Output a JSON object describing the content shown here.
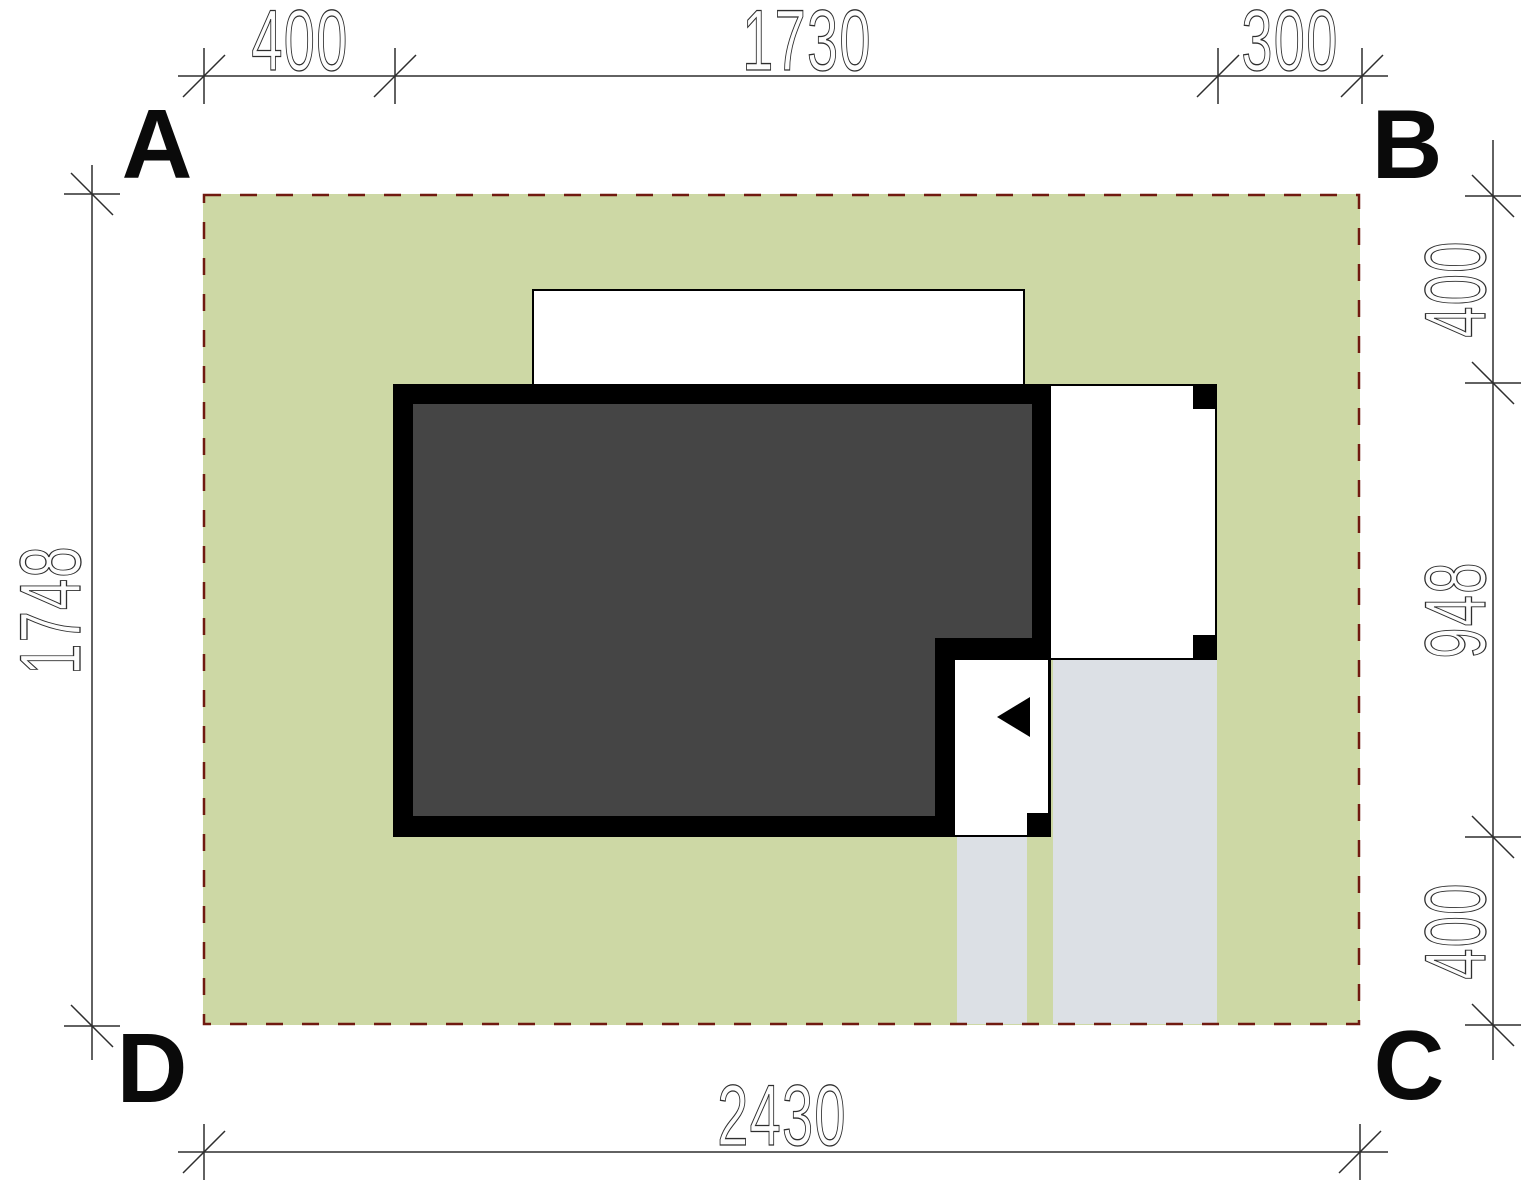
{
  "drawing": {
    "title": "site-plan",
    "corner_labels": {
      "top_left": "A",
      "top_right": "B",
      "bottom_right": "C",
      "bottom_left": "D"
    },
    "dimensions": {
      "top": [
        "400",
        "1730",
        "300"
      ],
      "right": [
        "400",
        "948",
        "400"
      ],
      "left": "1748",
      "bottom": "2430"
    },
    "colors": {
      "plot_green": "#cdd8a5",
      "boundary_dash_red": "#701a10",
      "building_fill_dark": "#454545",
      "wall_black": "#000000",
      "paving_gray": "#dce0e5",
      "dimension_line": "#2e2e2e"
    }
  }
}
